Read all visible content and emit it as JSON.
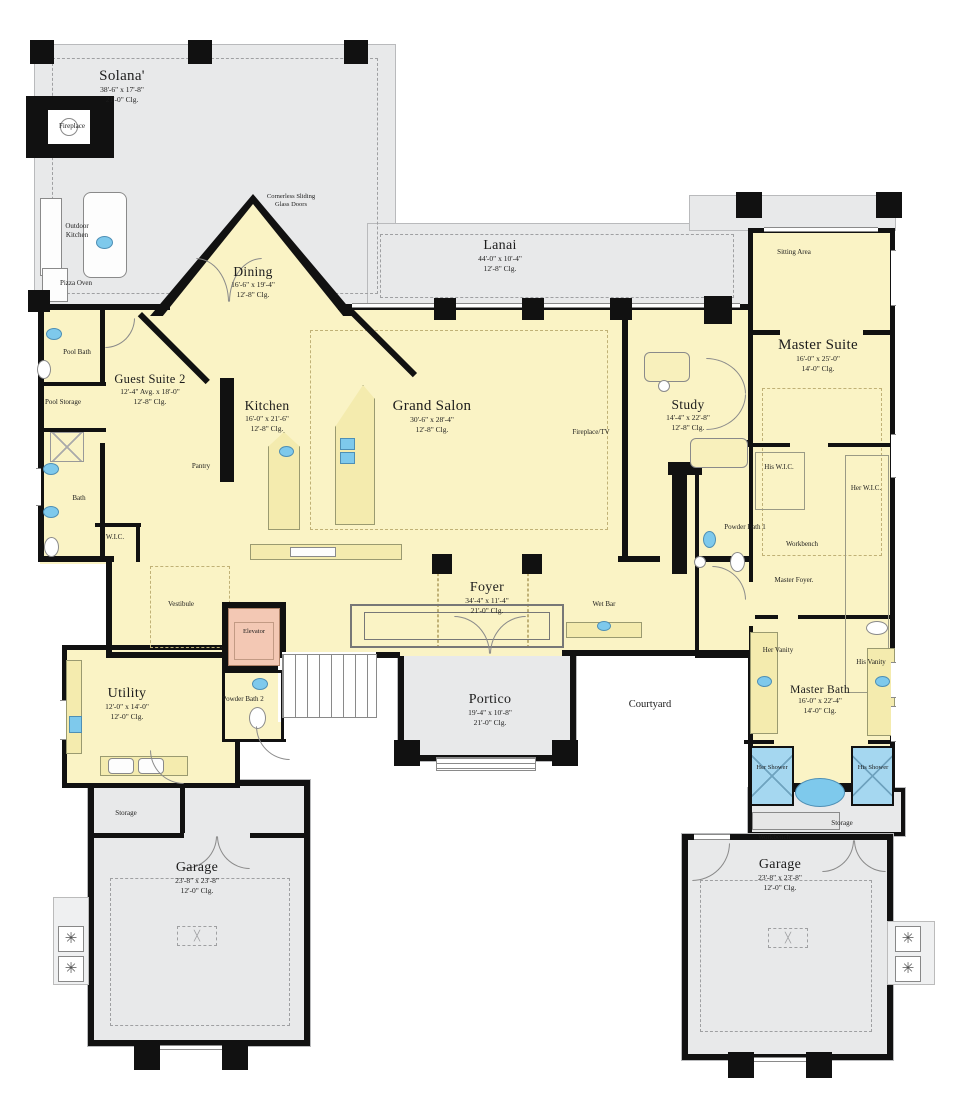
{
  "plan_title": "Residential first-floor plan",
  "colors": {
    "interior": "#FAF3C5",
    "outdoor": "#E8E9EA",
    "wall": "#111111",
    "fixture_blue": "#7EC9EC",
    "shower_blue": "#A5D7F0",
    "elevator_pink": "#F3C8B4"
  },
  "rooms": [
    {
      "id": "solana",
      "name": "Solana'",
      "dim": "38'-6\" x 17'-8\"",
      "clg": "21'-0\" Clg."
    },
    {
      "id": "dining",
      "name": "Dining",
      "dim": "16'-6\" x 19'-4\"",
      "clg": "12'-8\" Clg."
    },
    {
      "id": "lanai",
      "name": "Lanai",
      "dim": "44'-0\" x 10'-4\"",
      "clg": "12'-8\" Clg."
    },
    {
      "id": "master_suite",
      "name": "Master Suite",
      "dim": "16'-0\" x 25'-0\"",
      "clg": "14'-0\" Clg."
    },
    {
      "id": "guest_suite_2",
      "name": "Guest Suite 2",
      "dim": "12'-4\" Avg. x 18'-0\"",
      "clg": "12'-8\" Clg."
    },
    {
      "id": "kitchen",
      "name": "Kitchen",
      "dim": "16'-0\" x 21'-6\"",
      "clg": "12'-8\" Clg."
    },
    {
      "id": "grand_salon",
      "name": "Grand Salon",
      "dim": "30'-6\" x 28'-4\"",
      "clg": "12'-8\" Clg."
    },
    {
      "id": "study",
      "name": "Study",
      "dim": "14'-4\" x 22'-8\"",
      "clg": "12'-8\" Clg."
    },
    {
      "id": "foyer",
      "name": "Foyer",
      "dim": "34'-4\" x 11'-4\"",
      "clg": "21'-0\" Clg."
    },
    {
      "id": "utility",
      "name": "Utility",
      "dim": "12'-0\" x 14'-0\"",
      "clg": "12'-0\" Clg."
    },
    {
      "id": "portico",
      "name": "Portico",
      "dim": "19'-4\" x 10'-8\"",
      "clg": "21'-0\" Clg."
    },
    {
      "id": "master_bath",
      "name": "Master Bath",
      "dim": "16'-0\" x 22'-4\"",
      "clg": "14'-0\" Clg."
    },
    {
      "id": "garage_left",
      "name": "Garage",
      "dim": "23'-8\" x 23'-8\"",
      "clg": "12'-0\" Clg."
    },
    {
      "id": "garage_right",
      "name": "Garage",
      "dim": "23'-8\" x 23'-8\"",
      "clg": "12'-0\" Clg."
    }
  ],
  "labels": {
    "fireplace": "Fireplace",
    "outdoor_kitchen": "Outdoor Kitchen",
    "pizza_oven": "Pizza Oven",
    "cornerless_doors": "Cornerless Sliding Glass Doors",
    "sitting_area": "Sitting Area",
    "pool_bath": "Pool Bath",
    "pool_storage": "Pool Storage",
    "bath": "Bath",
    "wic": "W.I.C.",
    "pantry": "Pantry",
    "fireplace_tv": "Fireplace/TV",
    "his_wic": "His W.I.C.",
    "her_wic": "Her W.I.C.",
    "powder_bath_1": "Powder Bath 1",
    "workbench_1": "Workbench",
    "master_foyer": "Master Foyer.",
    "wet_bar": "Wet Bar",
    "vestibule": "Vestibule",
    "elevator": "Elevator",
    "powder_bath_2": "Powder Bath 2",
    "courtyard": "Courtyard",
    "her_vanity": "Her Vanity",
    "his_vanity": "His Vanity",
    "her_shower": "Her Shower",
    "his_shower": "His Shower",
    "storage_left": "Storage",
    "workbench_2": "Workbench",
    "storage_right": "Storage"
  }
}
